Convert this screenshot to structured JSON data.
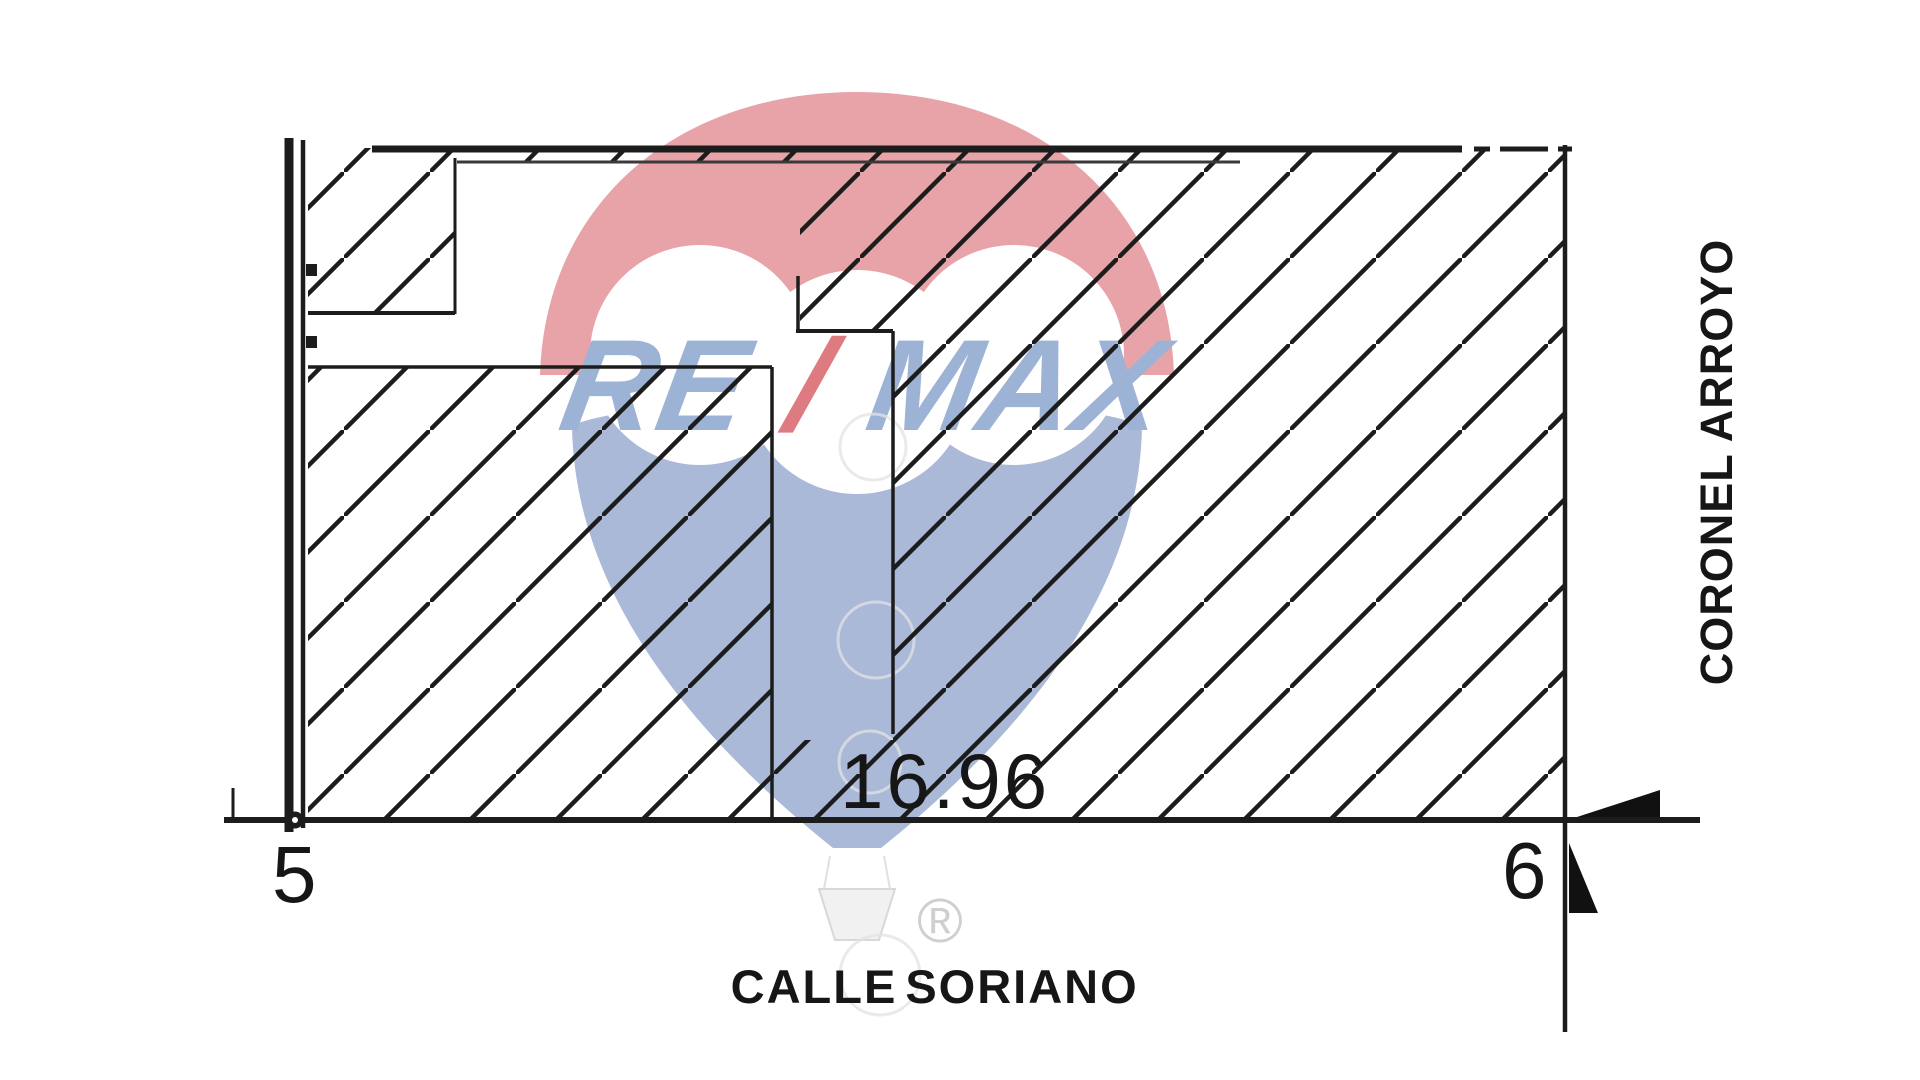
{
  "plan": {
    "labels": {
      "dimension": "16.96",
      "corner_left": "5",
      "corner_right": "6",
      "street_bottom_word1": "CALLE",
      "street_bottom_word2": "SORIANO",
      "street_right": "CORONEL ARROYO"
    },
    "watermark": {
      "brand_re": "RE",
      "brand_slash": "/",
      "brand_max": "MAX",
      "registered": "®"
    },
    "colors": {
      "line": "#1c1c1c",
      "balloon_red": "#e7a3a8",
      "balloon_blue": "#aab9d8",
      "logo_text_blue": "#9db3d6",
      "logo_slash_red": "#de7b80",
      "label_text": "#161616"
    }
  }
}
